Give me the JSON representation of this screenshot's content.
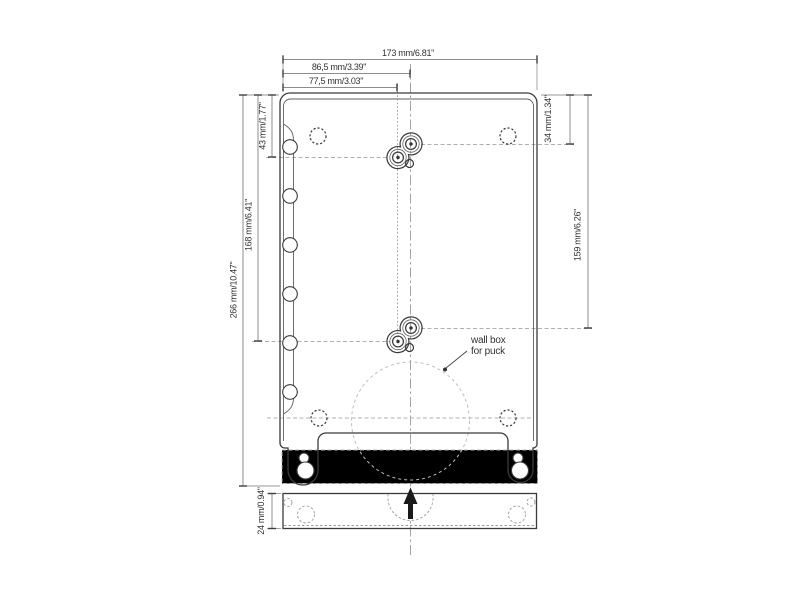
{
  "drawing": {
    "title": "wall plate mounting dimensions",
    "dims": {
      "top": [
        {
          "label": "173 mm/6.81\""
        },
        {
          "label": "86,5 mm/3.39\""
        },
        {
          "label": "77,5 mm/3.03\""
        }
      ],
      "left": [
        {
          "label": "266 mm/10.47\""
        },
        {
          "label": "168 mm/6.41\""
        },
        {
          "label": "43 mm/1.77\""
        }
      ],
      "right": [
        {
          "label": "34 mm/1.34\""
        },
        {
          "label": "159 mm/6.26\""
        }
      ],
      "bottom": [
        {
          "label": "24 mm/0.94\""
        }
      ]
    },
    "annotation": {
      "line1": "wall box",
      "line2": "for puck"
    },
    "colors": {
      "background": "#ffffff",
      "outline": "#3a3a3a",
      "dimension_lines": "#8c8c8c",
      "text": "#333333",
      "hidden_dashed": "#b0b0b0",
      "wall_box_circle": "#bdbdbd",
      "arrow": "#1a1a1a"
    }
  }
}
